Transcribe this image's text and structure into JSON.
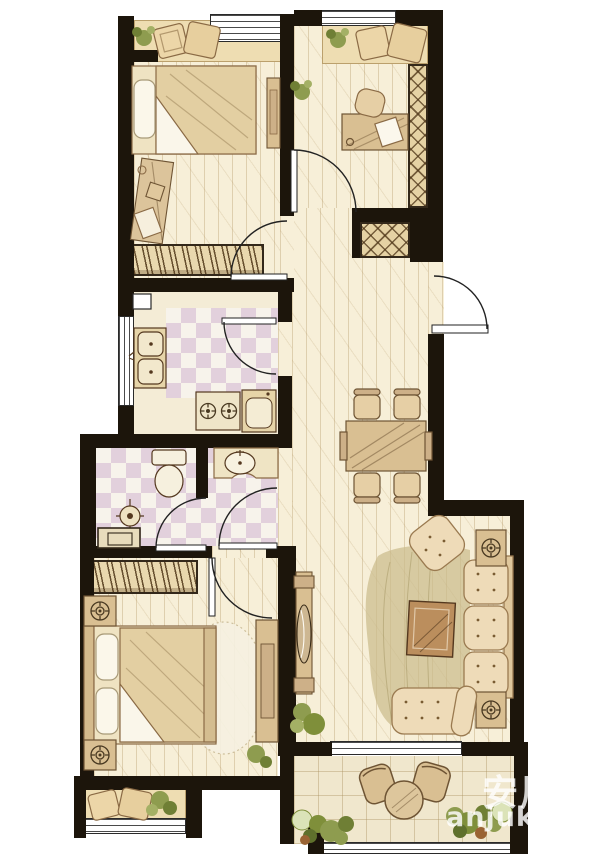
{
  "watermark": {
    "cjk": "安居客",
    "latin": "anjuke.com"
  },
  "palette": {
    "wall": "#1c150b",
    "wood_floor": "#f7efd8",
    "bay_sill": "#eeddb2",
    "tile_square": "#e2d0dc",
    "balcony_floor": "#f0e7cd",
    "furniture_wood": "#d9bf92",
    "cushion": "#eedbb8",
    "outline_brown": "#6e5434",
    "plant_green": "#8e9c4f",
    "watermark_white": "rgba(255,255,255,0.8)"
  },
  "legend": {
    "type": "apartment-floor-plan",
    "rooms": [
      "bedroom-upper-left",
      "study-upper-right",
      "kitchen",
      "bathroom",
      "bedroom-lower-left",
      "entry-hall",
      "living-dining-room",
      "balcony"
    ],
    "fixtures": [
      "double-bed",
      "wardrobe",
      "dressing-table",
      "study-desk",
      "bookshelf",
      "shoe-cabinet",
      "double-sink",
      "gas-stove",
      "refrigerator",
      "toilet",
      "washbasin",
      "shower",
      "dining-table-4-chairs",
      "sofa-3-seat",
      "armchair",
      "coffee-table",
      "tv-cabinet",
      "side-table-lamps",
      "bench",
      "bay-window-cushions",
      "balcony-chairs",
      "round-table",
      "plants"
    ]
  }
}
